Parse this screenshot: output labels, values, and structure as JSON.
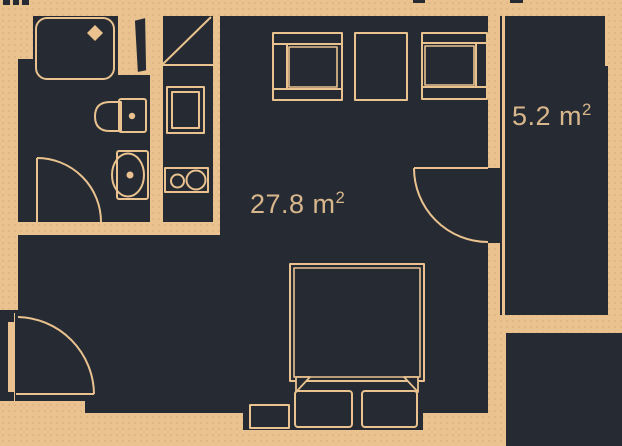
{
  "plan": {
    "type": "apartment-floor-plan",
    "rooms": {
      "main": {
        "value": "27.8 m",
        "sup": "2",
        "full_label": "27.8 m²"
      },
      "balcony": {
        "value": "5.2 m",
        "sup": "2",
        "full_label": "5.2 m²"
      }
    },
    "fixtures": [
      "shower-tray",
      "toilet",
      "sink",
      "ventilation-shaft",
      "washing-machine",
      "cooktop",
      "wardrobe-left",
      "wardrobe-middle",
      "wardrobe-right",
      "double-bed",
      "pillows",
      "nightstand",
      "bathroom-door-swing",
      "balcony-door-swing",
      "entrance-door-swing",
      "balcony-glazing"
    ],
    "colors": {
      "background_tan": "#e9c28f",
      "floor_dark": "#262b33",
      "line_tan": "#e9c28f",
      "label_tan": "#d9b78c"
    }
  }
}
